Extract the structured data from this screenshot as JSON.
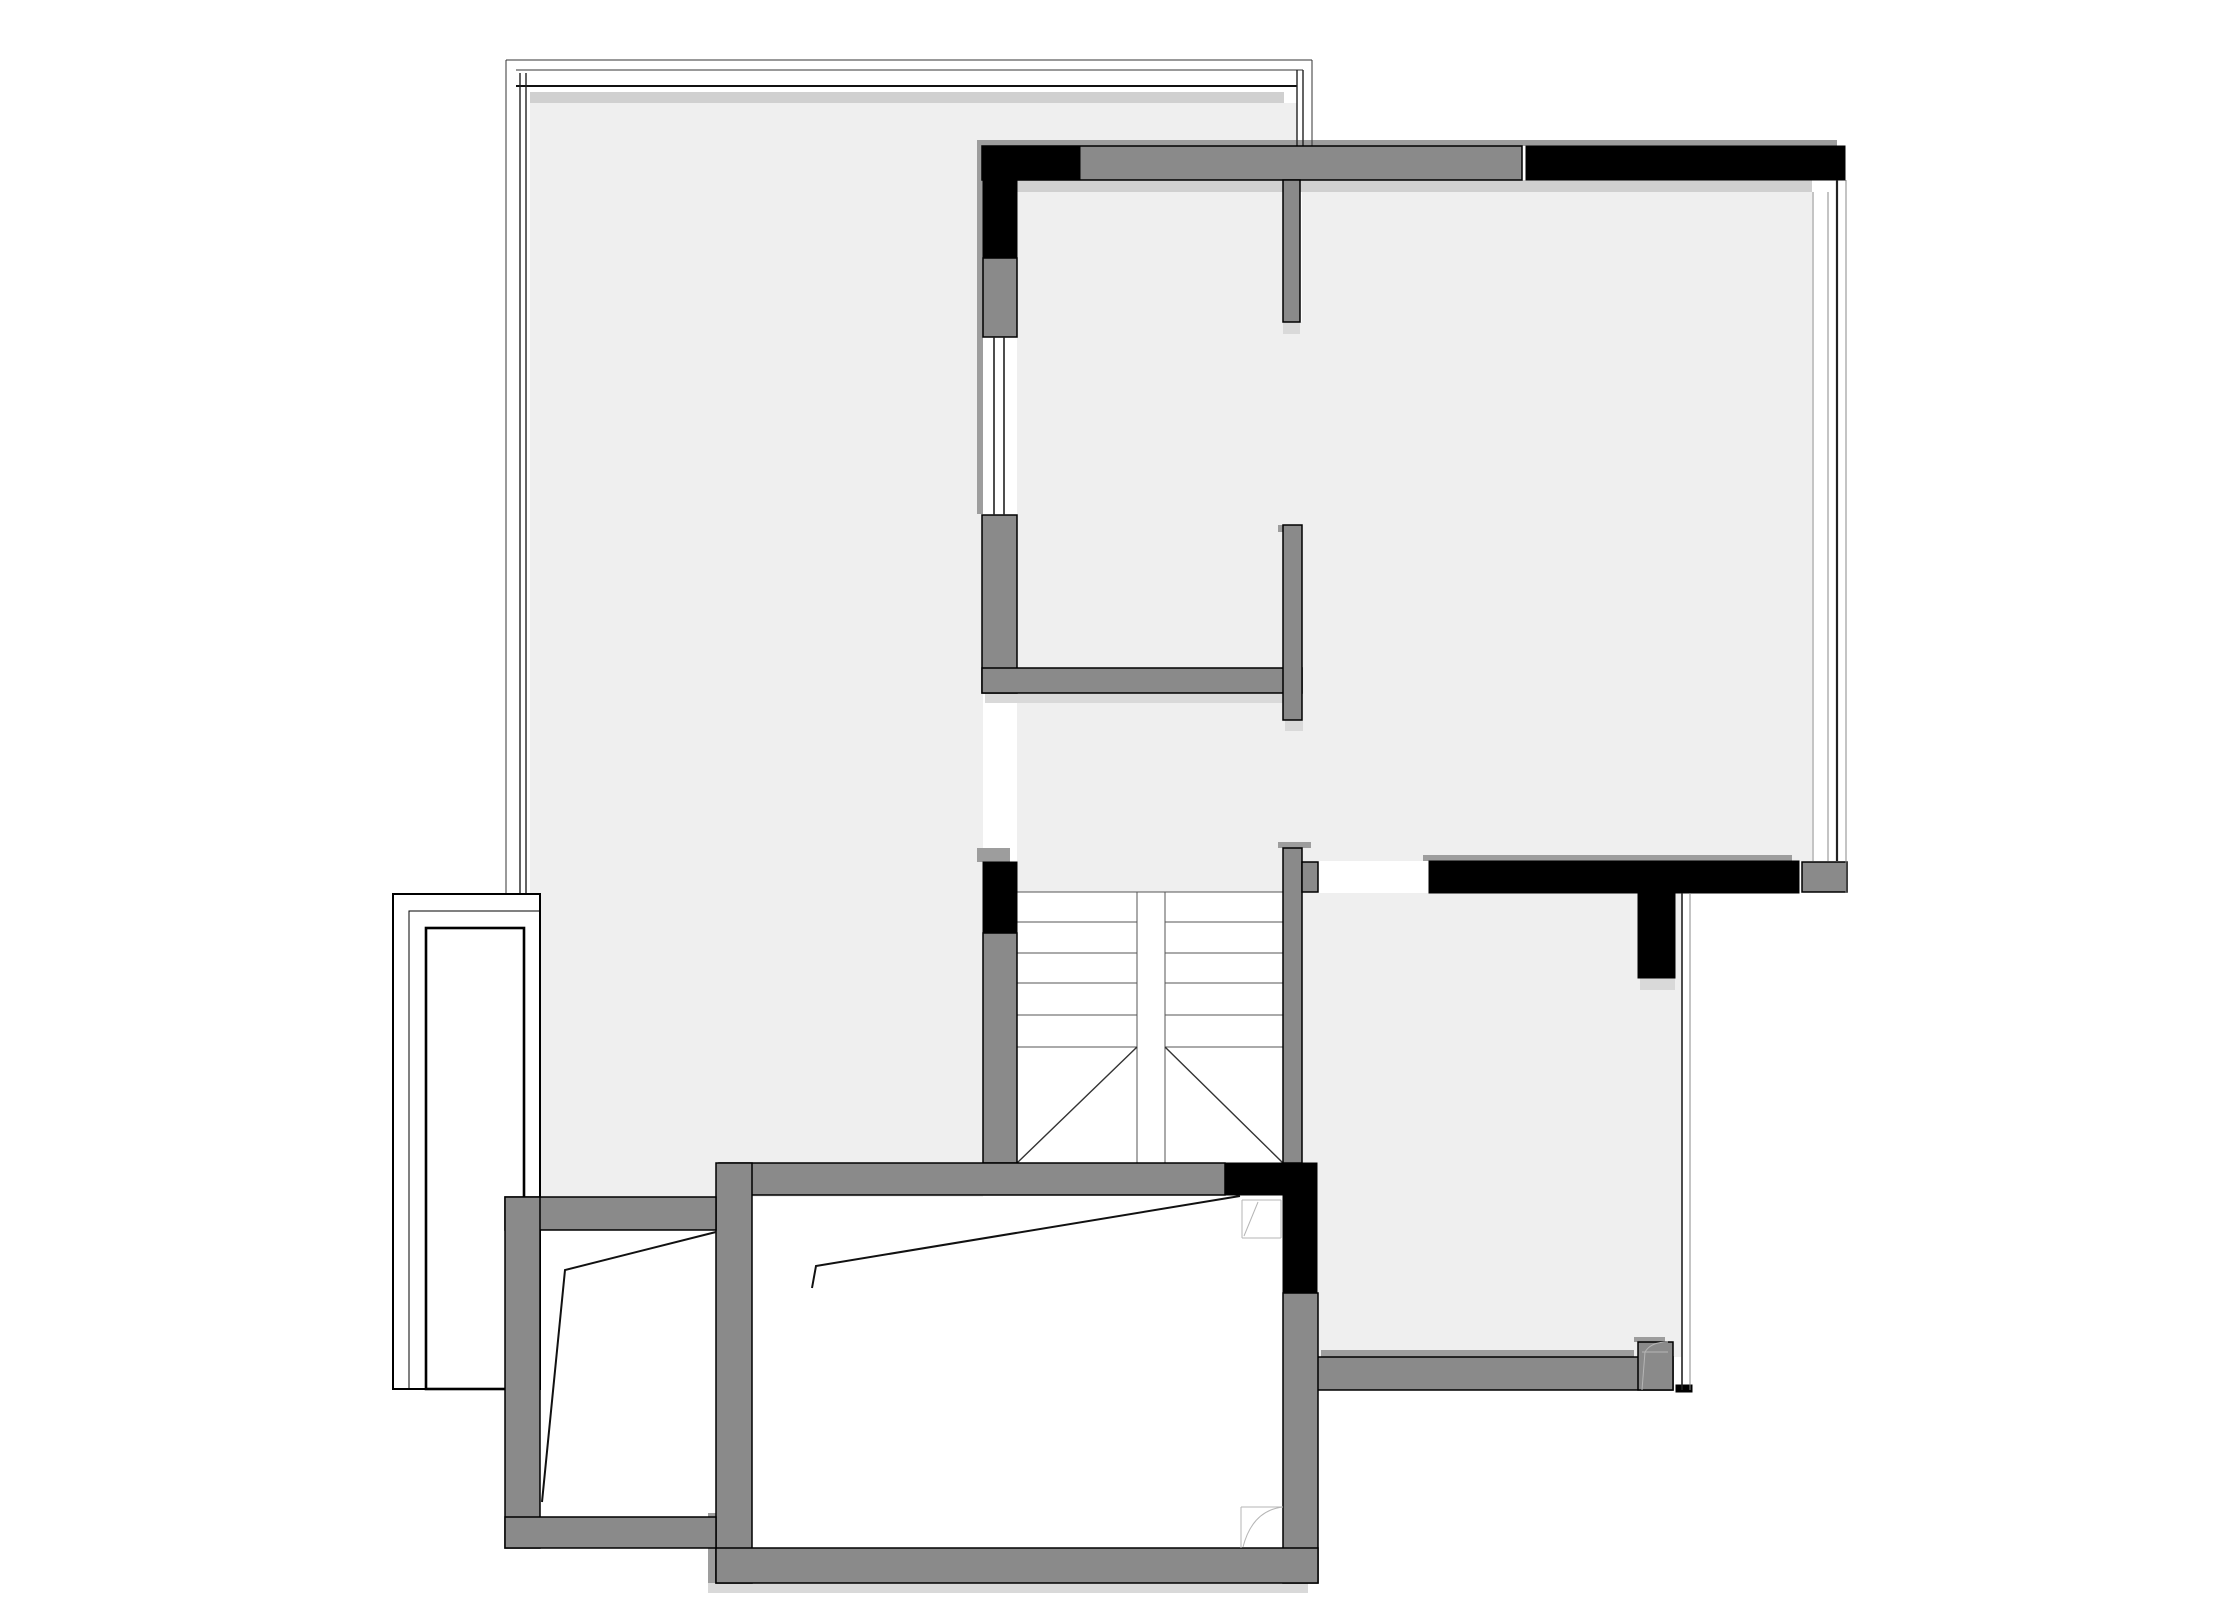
{
  "document": {
    "type": "architectural-floor-plan",
    "visible_text_labels": []
  },
  "colors": {
    "background": "#ffffff",
    "floor": "#efefef",
    "wall": "#8a8a8a",
    "wall_dark": "#000000",
    "wall_shadow": "#9d9d9d",
    "light_shadow": "#d9d9d9",
    "band_strip": "#d0d0d0",
    "line": "#000000",
    "stair_line": "#555555",
    "sketch_line": "#b5b5b5"
  },
  "stairs": {
    "flights": 2,
    "treads_visible_per_flight": 5,
    "has_break_diagonals": true,
    "direction": "double flight meeting at center"
  }
}
